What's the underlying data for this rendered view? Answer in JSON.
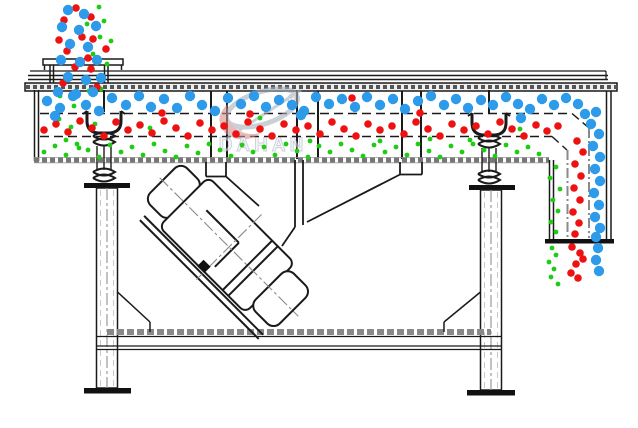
{
  "diagram": {
    "type": "technical-diagram",
    "subject": "linear vibrating screen side-section with three-size particle separation",
    "watermark": {
      "brand": "DAHAN",
      "registered_mark": "R"
    },
    "colors": {
      "linework": "#1a1a1a",
      "hatch_gray": "#8a8a8a",
      "particle_large": "#2E9BEA",
      "particle_medium": "#ED1111",
      "particle_small": "#1FCC14",
      "watermark_gray": "#A9B2BE",
      "watermark_accent": "#D98E8E"
    },
    "particles": {
      "large": {
        "label": "large particles - retained on top deck",
        "color": "#2E9BEA",
        "radius": 5.2,
        "points": [
          [
            68,
            10
          ],
          [
            84,
            14
          ],
          [
            62,
            27
          ],
          [
            79,
            30
          ],
          [
            96,
            26
          ],
          [
            70,
            44
          ],
          [
            88,
            47
          ],
          [
            61,
            60
          ],
          [
            80,
            62
          ],
          [
            97,
            60
          ],
          [
            68,
            77
          ],
          [
            86,
            80
          ],
          [
            101,
            78
          ],
          [
            58,
            92
          ],
          [
            76,
            94
          ],
          [
            93,
            92
          ],
          [
            47,
            101
          ],
          [
            60,
            108
          ],
          [
            73,
            96
          ],
          [
            86,
            105
          ],
          [
            99,
            111
          ],
          [
            112,
            98
          ],
          [
            126,
            105
          ],
          [
            139,
            96
          ],
          [
            151,
            107
          ],
          [
            164,
            99
          ],
          [
            177,
            108
          ],
          [
            190,
            96
          ],
          [
            202,
            105
          ],
          [
            215,
            111
          ],
          [
            228,
            98
          ],
          [
            241,
            104
          ],
          [
            254,
            96
          ],
          [
            266,
            107
          ],
          [
            279,
            100
          ],
          [
            292,
            105
          ],
          [
            304,
            111
          ],
          [
            316,
            97
          ],
          [
            329,
            104
          ],
          [
            342,
            99
          ],
          [
            355,
            107
          ],
          [
            367,
            97
          ],
          [
            380,
            105
          ],
          [
            393,
            99
          ],
          [
            405,
            109
          ],
          [
            418,
            101
          ],
          [
            431,
            96
          ],
          [
            444,
            105
          ],
          [
            456,
            99
          ],
          [
            468,
            108
          ],
          [
            481,
            100
          ],
          [
            493,
            105
          ],
          [
            506,
            97
          ],
          [
            518,
            104
          ],
          [
            530,
            109
          ],
          [
            542,
            99
          ],
          [
            554,
            105
          ],
          [
            566,
            98
          ],
          [
            578,
            104
          ],
          [
            55,
            116
          ],
          [
            301,
            115
          ],
          [
            521,
            118
          ],
          [
            585,
            114
          ],
          [
            596,
            112
          ],
          [
            591,
            124
          ],
          [
            599,
            134
          ],
          [
            593,
            146
          ],
          [
            600,
            157
          ],
          [
            595,
            169
          ],
          [
            600,
            181
          ],
          [
            594,
            193
          ],
          [
            599,
            205
          ],
          [
            595,
            217
          ],
          [
            600,
            228
          ],
          [
            596,
            237
          ],
          [
            598,
            248
          ],
          [
            596,
            260
          ],
          [
            599,
            271
          ]
        ]
      },
      "medium": {
        "label": "medium particles - middle deck",
        "color": "#ED1111",
        "radius": 3.8,
        "points": [
          [
            76,
            8
          ],
          [
            91,
            17
          ],
          [
            64,
            20
          ],
          [
            82,
            37
          ],
          [
            67,
            51
          ],
          [
            93,
            39
          ],
          [
            75,
            67
          ],
          [
            91,
            69
          ],
          [
            63,
            83
          ],
          [
            97,
            87
          ],
          [
            106,
            49
          ],
          [
            59,
            40
          ],
          [
            88,
            58
          ],
          [
            44,
            130
          ],
          [
            56,
            124
          ],
          [
            68,
            132
          ],
          [
            80,
            121
          ],
          [
            92,
            128
          ],
          [
            104,
            136
          ],
          [
            116,
            122
          ],
          [
            128,
            130
          ],
          [
            140,
            125
          ],
          [
            152,
            133
          ],
          [
            164,
            121
          ],
          [
            176,
            128
          ],
          [
            188,
            136
          ],
          [
            200,
            123
          ],
          [
            212,
            130
          ],
          [
            224,
            126
          ],
          [
            236,
            134
          ],
          [
            248,
            122
          ],
          [
            260,
            129
          ],
          [
            272,
            136
          ],
          [
            284,
            124
          ],
          [
            296,
            130
          ],
          [
            308,
            126
          ],
          [
            320,
            134
          ],
          [
            332,
            122
          ],
          [
            344,
            129
          ],
          [
            356,
            136
          ],
          [
            368,
            124
          ],
          [
            380,
            130
          ],
          [
            392,
            126
          ],
          [
            404,
            134
          ],
          [
            416,
            122
          ],
          [
            428,
            129
          ],
          [
            440,
            136
          ],
          [
            452,
            124
          ],
          [
            464,
            130
          ],
          [
            476,
            126
          ],
          [
            488,
            134
          ],
          [
            500,
            122
          ],
          [
            512,
            129
          ],
          [
            524,
            136
          ],
          [
            536,
            125
          ],
          [
            547,
            131
          ],
          [
            558,
            126
          ],
          [
            352,
            98
          ],
          [
            420,
            113
          ],
          [
            162,
            113
          ],
          [
            250,
            114
          ],
          [
            577,
            141
          ],
          [
            583,
            152
          ],
          [
            575,
            164
          ],
          [
            581,
            176
          ],
          [
            574,
            188
          ],
          [
            580,
            200
          ],
          [
            573,
            212
          ],
          [
            579,
            223
          ],
          [
            575,
            234
          ],
          [
            572,
            247
          ],
          [
            580,
            253
          ],
          [
            576,
            264
          ],
          [
            583,
            259
          ],
          [
            571,
            273
          ],
          [
            578,
            278
          ]
        ]
      },
      "small": {
        "label": "fine particles - bottom pan",
        "color": "#1FCC14",
        "radius": 2.4,
        "points": [
          [
            99,
            7
          ],
          [
            104,
            21
          ],
          [
            87,
            24
          ],
          [
            100,
            37
          ],
          [
            111,
            41
          ],
          [
            93,
            54
          ],
          [
            107,
            64
          ],
          [
            89,
            91
          ],
          [
            101,
            89
          ],
          [
            97,
            109
          ],
          [
            95,
            124
          ],
          [
            60,
            96
          ],
          [
            74,
            106
          ],
          [
            59,
            119
          ],
          [
            71,
            127
          ],
          [
            66,
            140
          ],
          [
            79,
            148
          ],
          [
            44,
            152
          ],
          [
            55,
            146
          ],
          [
            66,
            155
          ],
          [
            77,
            144
          ],
          [
            88,
            150
          ],
          [
            99,
            157
          ],
          [
            110,
            145
          ],
          [
            121,
            152
          ],
          [
            132,
            147
          ],
          [
            143,
            155
          ],
          [
            154,
            144
          ],
          [
            165,
            151
          ],
          [
            176,
            157
          ],
          [
            187,
            146
          ],
          [
            198,
            153
          ],
          [
            209,
            144
          ],
          [
            220,
            150
          ],
          [
            231,
            156
          ],
          [
            242,
            145
          ],
          [
            253,
            152
          ],
          [
            264,
            147
          ],
          [
            275,
            155
          ],
          [
            286,
            144
          ],
          [
            297,
            151
          ],
          [
            308,
            157
          ],
          [
            319,
            146
          ],
          [
            330,
            152
          ],
          [
            341,
            144
          ],
          [
            352,
            150
          ],
          [
            363,
            156
          ],
          [
            374,
            145
          ],
          [
            385,
            152
          ],
          [
            396,
            147
          ],
          [
            407,
            155
          ],
          [
            418,
            144
          ],
          [
            429,
            151
          ],
          [
            440,
            157
          ],
          [
            451,
            146
          ],
          [
            462,
            152
          ],
          [
            473,
            144
          ],
          [
            484,
            150
          ],
          [
            495,
            156
          ],
          [
            506,
            145
          ],
          [
            517,
            152
          ],
          [
            528,
            147
          ],
          [
            539,
            154
          ],
          [
            150,
            128
          ],
          [
            310,
            141
          ],
          [
            430,
            139
          ],
          [
            520,
            129
          ],
          [
            260,
            118
          ],
          [
            380,
            141
          ],
          [
            470,
            140
          ],
          [
            556,
            167
          ],
          [
            550,
            178
          ],
          [
            560,
            189
          ],
          [
            553,
            200
          ],
          [
            558,
            211
          ],
          [
            551,
            222
          ],
          [
            556,
            232
          ],
          [
            552,
            248
          ],
          [
            556,
            255
          ],
          [
            549,
            262
          ],
          [
            554,
            269
          ],
          [
            551,
            277
          ],
          [
            558,
            284
          ]
        ]
      }
    }
  }
}
